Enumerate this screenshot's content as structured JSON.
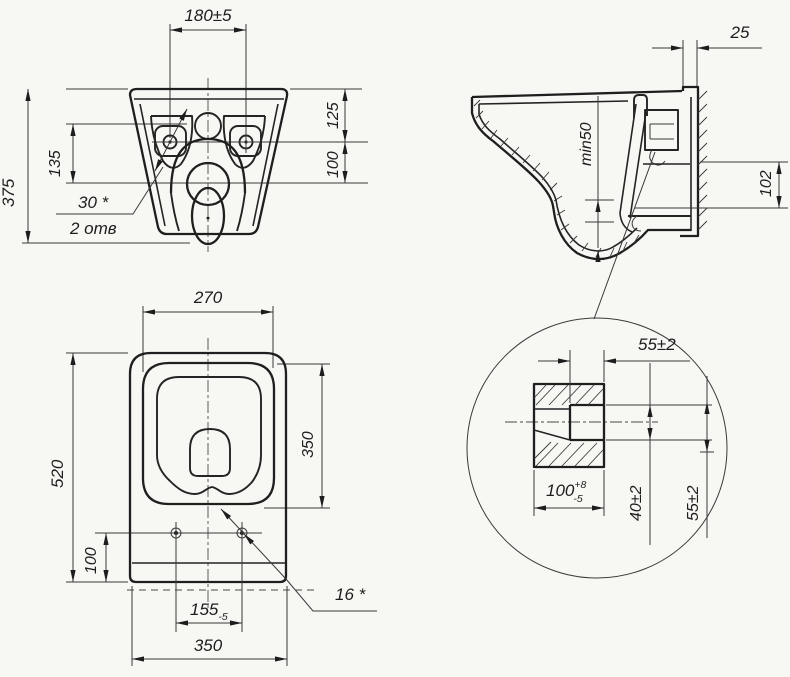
{
  "drawing": {
    "type": "technical-drawing",
    "subject": "wall-hung toilet bowl dimensional drawing",
    "colors": {
      "background": "#f7f7f4",
      "line": "#1f1f1f",
      "dimension_line": "#3a3a3a"
    },
    "views": {
      "front": {
        "name": "front-view",
        "dims": {
          "hole_spacing": "180±5",
          "overall_height": "375",
          "hole_drop": "135",
          "top_to_hole": "125",
          "hole_to_rim": "100",
          "hole_note_dim": "30 *",
          "hole_note_count": "2 отв"
        }
      },
      "side": {
        "name": "side-section-view",
        "dims": {
          "plate_depth": "25",
          "water_seal": "min50",
          "outlet_height": "102"
        }
      },
      "plan": {
        "name": "plan-view",
        "dims": {
          "seat_width": "270",
          "overall_length": "520",
          "bowl_length": "350",
          "hole_edge_offset": "100",
          "hole_spacing_value": "155",
          "hole_spacing_tol": "-5",
          "overall_width": "350",
          "hole_dia_note": "16 *"
        }
      },
      "detail": {
        "name": "outlet-detail-view",
        "dims": {
          "socket_depth": "55±2",
          "spigot_length_value": "100",
          "spigot_length_tol_up": "+8",
          "spigot_length_tol_dn": "-5",
          "bore_height": "40±2",
          "outer_height": "55±2"
        }
      }
    }
  }
}
